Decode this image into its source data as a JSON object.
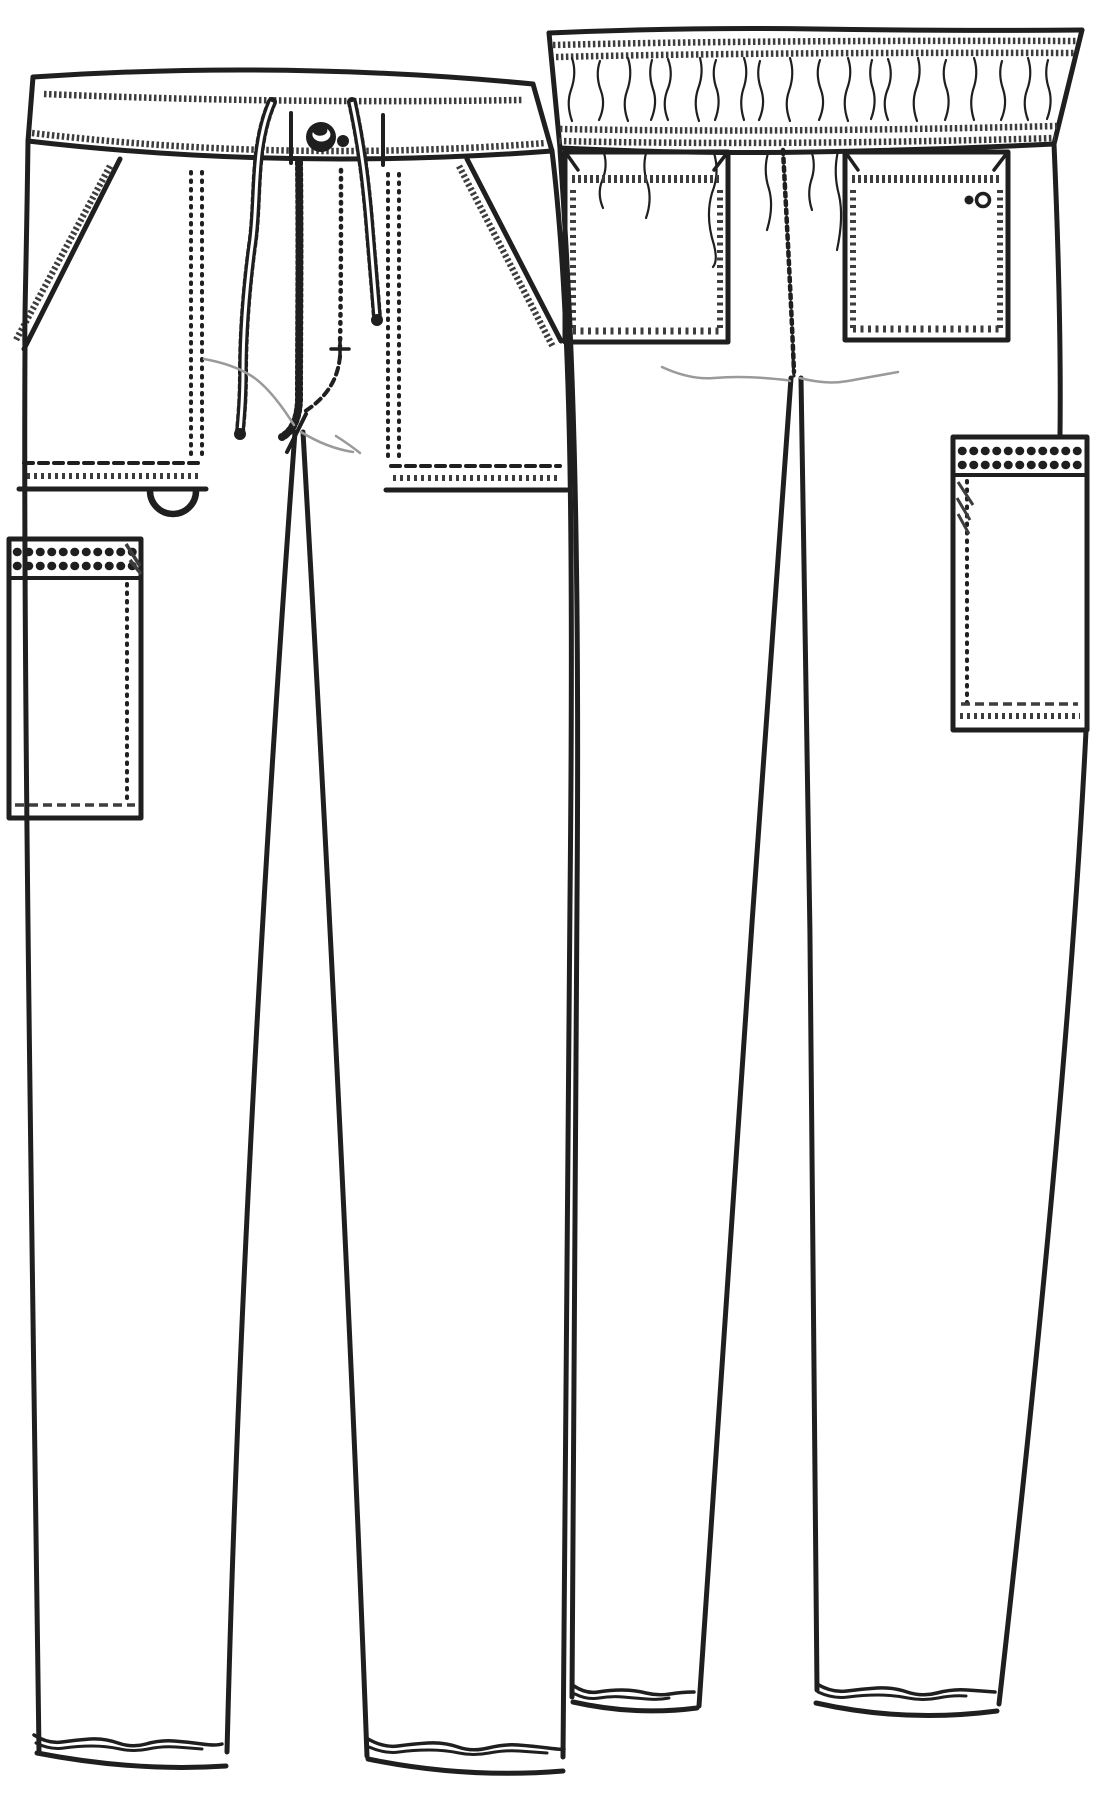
{
  "illustration": {
    "kind": "garment-technical-flat-sketch",
    "subject": "drawstring-cargo-scrub-pants",
    "views": [
      {
        "id": "front",
        "features": [
          "drawstring-waistband",
          "button",
          "fly-topstitch",
          "slant-pockets",
          "d-ring-loop",
          "side-cargo-pocket-left"
        ]
      },
      {
        "id": "back",
        "features": [
          "elastic-waistband",
          "patch-pockets",
          "brand-double-ring-logo",
          "center-back-seam",
          "side-cargo-pocket-right"
        ]
      }
    ],
    "logo": "double-ring-logo"
  },
  "colors": {
    "paper": "#ffffff",
    "ink": "#1f1f1f",
    "stitch": "#3d3d3d",
    "shade": "#9a9a9a"
  }
}
